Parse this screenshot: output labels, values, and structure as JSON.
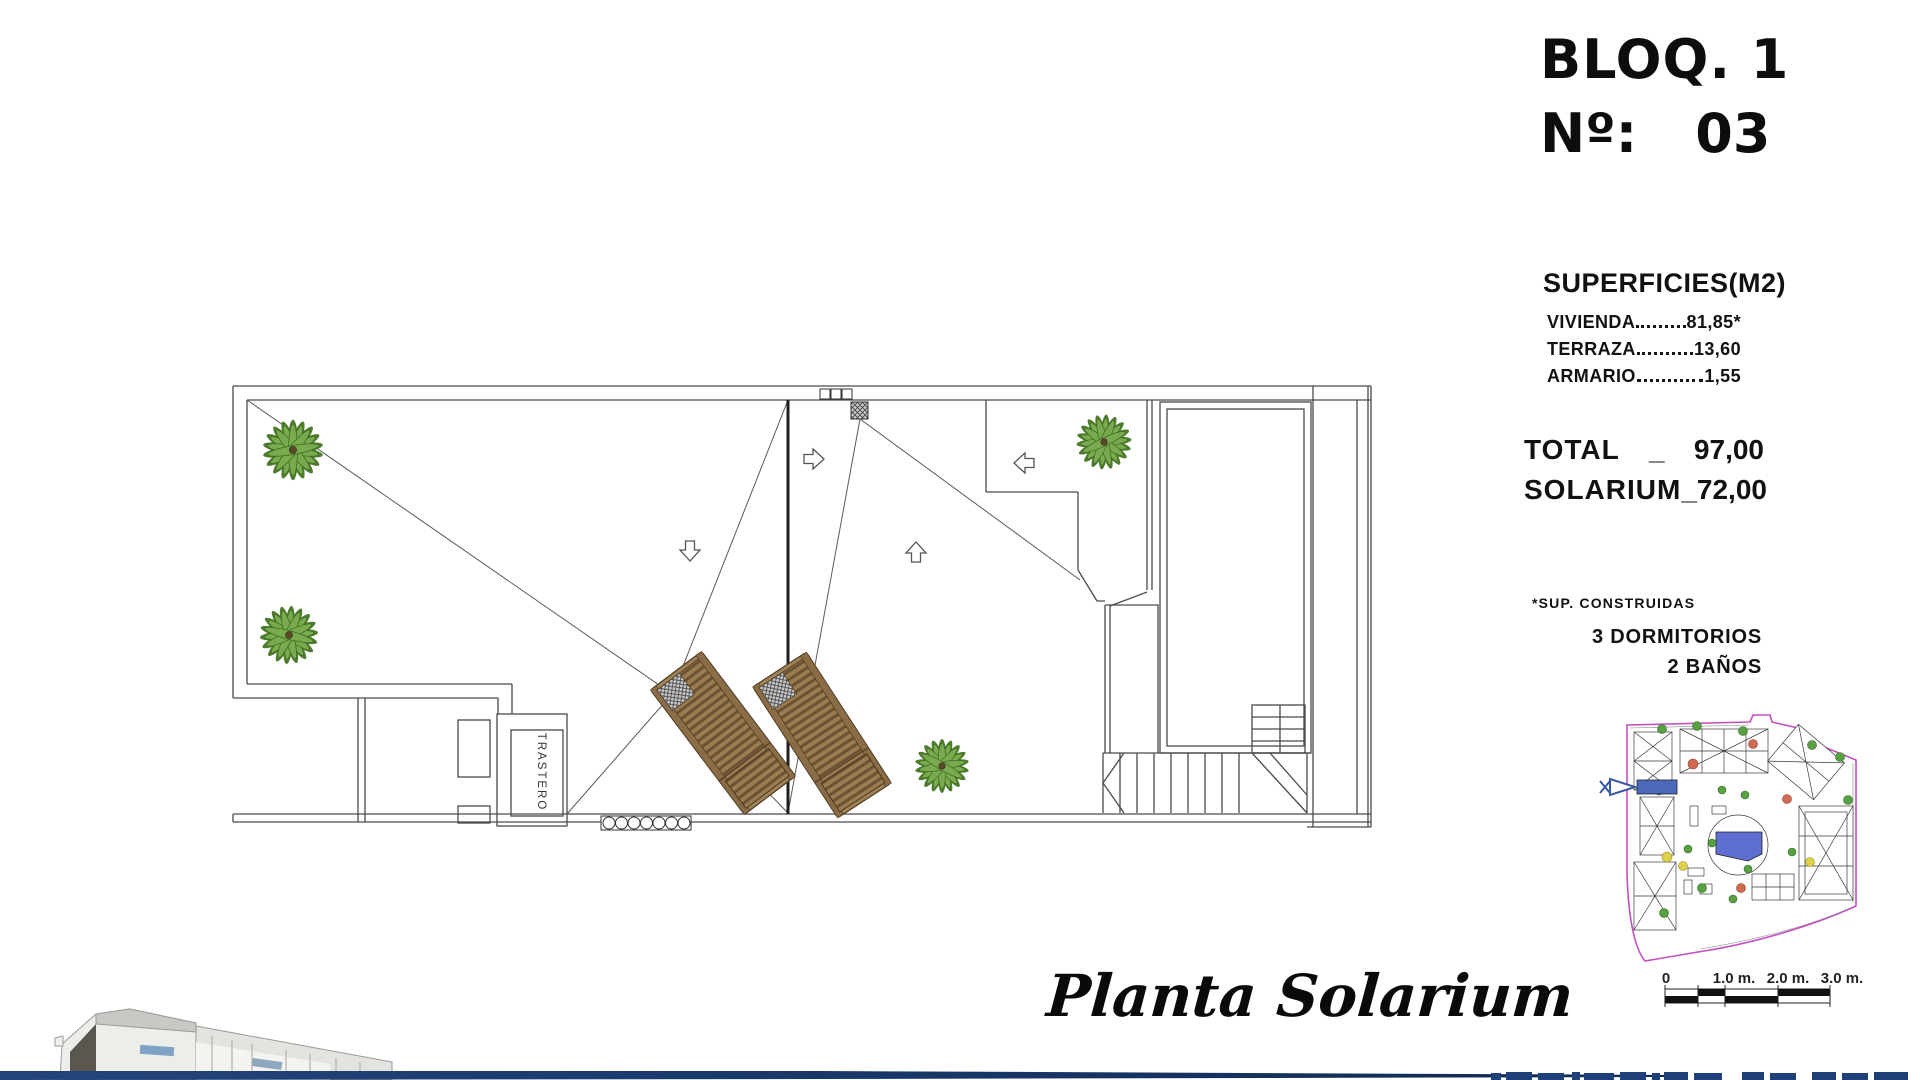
{
  "header": {
    "block_label": "BLOQ. 1",
    "number_prefix": "Nº:",
    "unit_number": "03"
  },
  "surfaces": {
    "title": "SUPERFICIES(M2)",
    "rows": [
      {
        "label": "VIVIENDA",
        "value": "81,85*"
      },
      {
        "label": "TERRAZA",
        "value": "13,60"
      },
      {
        "label": "ARMARIO",
        "value": "1,55"
      }
    ]
  },
  "totals": {
    "separator": "_",
    "rows": [
      {
        "label": "TOTAL",
        "value": "97,00"
      },
      {
        "label": "SOLARIUM",
        "value": "72,00"
      }
    ]
  },
  "notes": {
    "footnote": "*SUP. CONSTRUIDAS",
    "bedrooms": "3 DORMITORIOS",
    "bathrooms": "2 BAÑOS"
  },
  "plan": {
    "title": "Planta Solarium",
    "storage_label": "TRASTERO"
  },
  "scale_bar": {
    "labels": [
      "0",
      "1.0 m.",
      "2.0 m.",
      "3.0 m."
    ]
  },
  "colors": {
    "accent_blue": "#4a69b8",
    "pointer_blue": "#3a57a5",
    "boundary_magenta": "#c44ec4",
    "palm_green": "#74a646",
    "lounger_brown": "#9a7c50",
    "pool_blue": "#5f6fd1",
    "footer_navy": "#1d3e72"
  }
}
